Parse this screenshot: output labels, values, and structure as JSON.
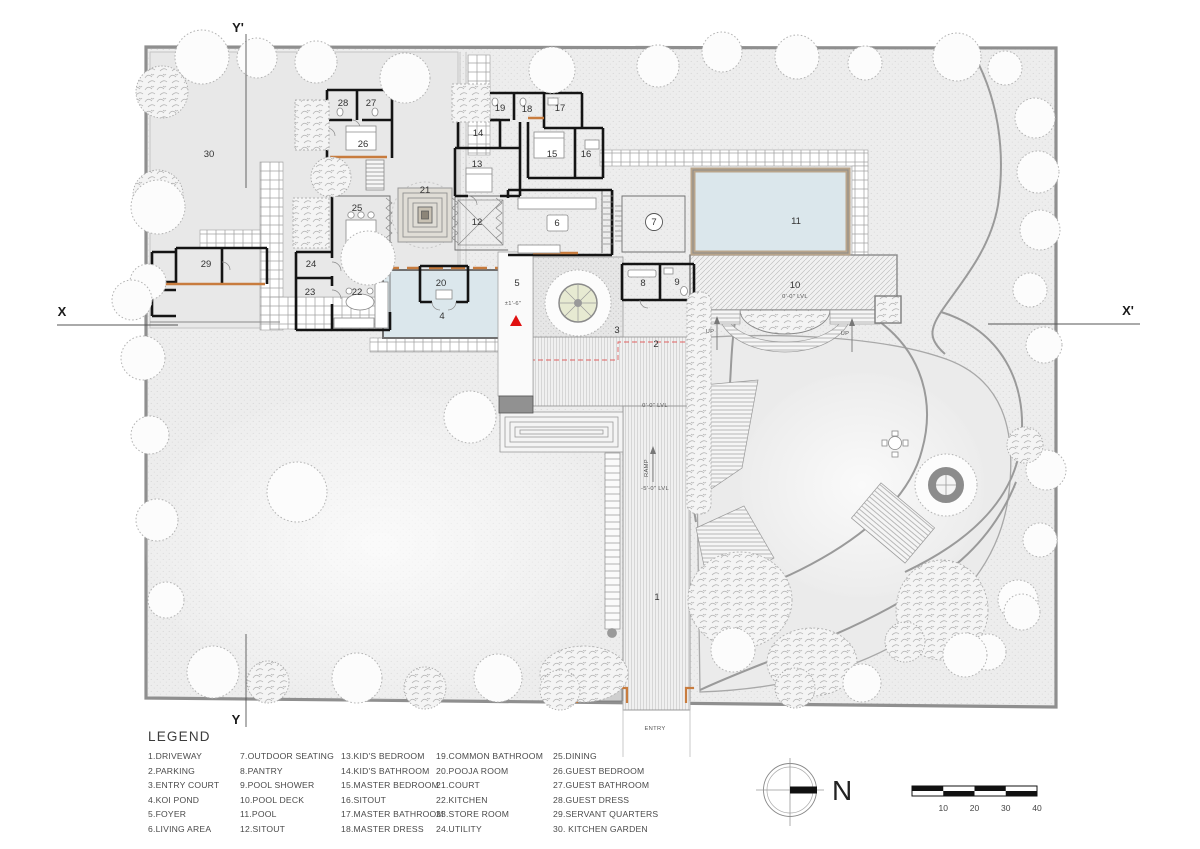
{
  "plan": {
    "room_labels": [
      {
        "n": "1",
        "x": 657,
        "y": 600
      },
      {
        "n": "2",
        "x": 656,
        "y": 347
      },
      {
        "n": "3",
        "x": 617,
        "y": 333
      },
      {
        "n": "4",
        "x": 442,
        "y": 319
      },
      {
        "n": "5",
        "x": 517,
        "y": 286
      },
      {
        "n": "6",
        "x": 557,
        "y": 226
      },
      {
        "n": "7",
        "x": 654,
        "y": 225
      },
      {
        "n": "8",
        "x": 643,
        "y": 286
      },
      {
        "n": "9",
        "x": 677,
        "y": 285
      },
      {
        "n": "10",
        "x": 795,
        "y": 288
      },
      {
        "n": "11",
        "x": 796,
        "y": 224
      },
      {
        "n": "12",
        "x": 477,
        "y": 225
      },
      {
        "n": "13",
        "x": 477,
        "y": 167
      },
      {
        "n": "14",
        "x": 478,
        "y": 136
      },
      {
        "n": "15",
        "x": 552,
        "y": 157
      },
      {
        "n": "16",
        "x": 586,
        "y": 157
      },
      {
        "n": "17",
        "x": 560,
        "y": 111
      },
      {
        "n": "18",
        "x": 527,
        "y": 112
      },
      {
        "n": "19",
        "x": 500,
        "y": 111
      },
      {
        "n": "20",
        "x": 441,
        "y": 286
      },
      {
        "n": "21",
        "x": 425,
        "y": 193
      },
      {
        "n": "22",
        "x": 357,
        "y": 295
      },
      {
        "n": "23",
        "x": 310,
        "y": 295
      },
      {
        "n": "24",
        "x": 311,
        "y": 267
      },
      {
        "n": "25",
        "x": 357,
        "y": 211
      },
      {
        "n": "26",
        "x": 363,
        "y": 147
      },
      {
        "n": "27",
        "x": 371,
        "y": 106
      },
      {
        "n": "28",
        "x": 343,
        "y": 106
      },
      {
        "n": "29",
        "x": 206,
        "y": 267
      },
      {
        "n": "30",
        "x": 209,
        "y": 157
      }
    ],
    "annotations": [
      {
        "t": "0'-0\" LVL",
        "x": 795,
        "y": 298
      },
      {
        "t": "0'-0\" LVL",
        "x": 655,
        "y": 407
      },
      {
        "t": "-5'-0\" LVL",
        "x": 655,
        "y": 490
      },
      {
        "t": "RAMP",
        "x": 648,
        "y": 468,
        "rot": -90
      },
      {
        "t": "UP",
        "x": 710,
        "y": 333
      },
      {
        "t": "UP",
        "x": 845,
        "y": 335
      },
      {
        "t": "ENTRY",
        "x": 655,
        "y": 730
      },
      {
        "t": "±1'-6\"",
        "x": 513,
        "y": 305
      }
    ],
    "section_markers": [
      {
        "t": "X",
        "x": 62,
        "y": 316
      },
      {
        "t": "X'",
        "x": 1128,
        "y": 315
      },
      {
        "t": "Y'",
        "x": 238,
        "y": 32
      },
      {
        "t": "Y",
        "x": 236,
        "y": 724
      }
    ]
  },
  "legend": {
    "title": "LEGEND",
    "columns": [
      [
        "1.DRIVEWAY",
        "2.PARKING",
        "3.ENTRY COURT",
        "4.KOI POND",
        "5.FOYER",
        "6.LIVING AREA"
      ],
      [
        "7.OUTDOOR SEATING",
        "8.PANTRY",
        "9.POOL SHOWER",
        "10.POOL DECK",
        "11.POOL",
        "12.SITOUT"
      ],
      [
        "13.KID'S BEDROOM",
        "14.KID'S BATHROOM",
        "15.MASTER BEDROOM",
        "16.SITOUT",
        "17.MASTER BATHROOM",
        "18.MASTER DRESS"
      ],
      [
        "19.COMMON BATHROOM",
        "20.POOJA ROOM",
        "21.COURT",
        "22.KITCHEN",
        "23.STORE ROOM",
        "24.UTILITY"
      ],
      [
        "25.DINING",
        "26.GUEST BEDROOM",
        "27.GUEST BATHROOM",
        "28.GUEST DRESS",
        "29.SERVANT QUARTERS",
        "30. KITCHEN GARDEN"
      ]
    ]
  },
  "compass": {
    "north_label": "N"
  },
  "scale_bar": {
    "tick_labels": [
      "10",
      "20",
      "30",
      "40"
    ]
  },
  "colors": {
    "wall": "#141414",
    "accent_orange": "#c87c3e",
    "water": "#dbe7ec",
    "pool_frame": "#b9a58b",
    "marker_red": "#e01010",
    "site_fill": "#ededed",
    "boundary": "#8f8f8f"
  }
}
